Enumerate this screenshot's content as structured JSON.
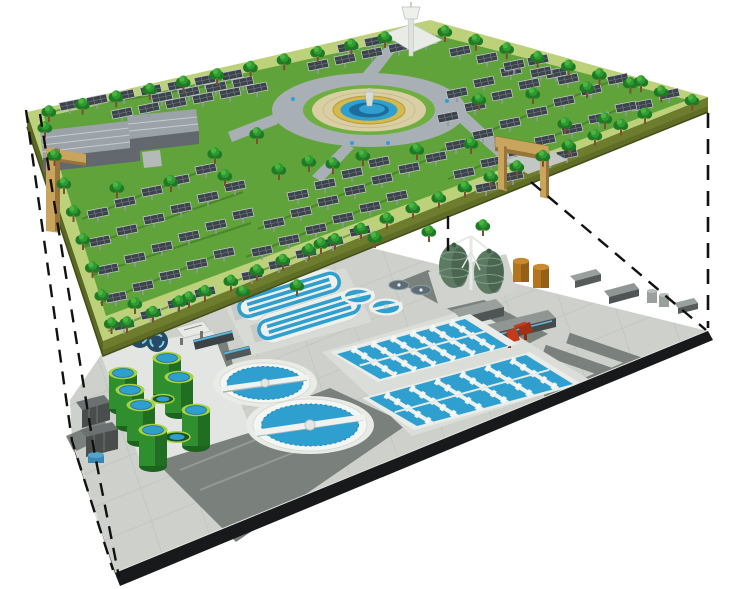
{
  "scene": {
    "description": "Cutaway concept illustration of a rooftop solar park and garden deck elevated above a wastewater treatment plant, with dashed projection lines linking the deck corners to the plant footprint",
    "upper_level": {
      "label": "Rooftop solar park and garden deck",
      "features": [
        {
          "name": "central-plaza",
          "label": "Circular plaza with tiered fountain",
          "count": 1
        },
        {
          "name": "observation-tower",
          "label": "White observation tower",
          "count": 1
        },
        {
          "name": "greenhouse-buildings",
          "label": "Gray ridged greenhouse buildings",
          "count": 2
        },
        {
          "name": "solar-panel-arrays",
          "label": "Rows of elevated solar panels",
          "approx_count": 107
        },
        {
          "name": "trees",
          "label": "Perimeter and infill trees",
          "approx_count": 74
        },
        {
          "name": "entrance-gates",
          "label": "Tan portal gate structures",
          "count": 2
        }
      ]
    },
    "lower_level": {
      "label": "Wastewater treatment plant",
      "features": [
        {
          "name": "circular-clarifiers",
          "label": "Circular clarifier tanks with rotating bridges",
          "count": 2
        },
        {
          "name": "oxidation-ditches",
          "label": "Racetrack oxidation ditches",
          "count": 2
        },
        {
          "name": "aeration-basins",
          "label": "Rectangular aeration basin blocks with walkways",
          "count": 2
        },
        {
          "name": "digester-eggs",
          "label": "Egg-shaped anaerobic digesters",
          "count": 2
        },
        {
          "name": "sludge-tanks-green",
          "label": "Green cylindrical sludge tanks",
          "count": 7
        },
        {
          "name": "storage-tanks-orange",
          "label": "Orange storage tanks",
          "count": 2
        },
        {
          "name": "small-round-tanks",
          "label": "Small round process tanks",
          "count": 4
        },
        {
          "name": "service-buildings",
          "label": "Gray service buildings",
          "count": 6
        },
        {
          "name": "red-pump-unit",
          "label": "Red pump equipment",
          "count": 1
        }
      ]
    },
    "annotations": {
      "label": "Dashed projection lines between deck and plant",
      "count": 5
    },
    "colors": {
      "grass": "#5fa33a",
      "grassEdge": "#bcd17a",
      "deckSide": "#6e7c2e",
      "deckSideDark": "#5a6823",
      "panel": "#3d434b",
      "tree": "#2f9a33",
      "treeDark": "#1f7a24",
      "treeLite": "#4cb53f",
      "trunk": "#7a5230",
      "plazaRoad": "#a9b0b5",
      "plazaPave": "#dacfa2",
      "fountainRing": "#d4b94f",
      "water": "#2f9fd0",
      "waterDark": "#1c6c9c",
      "pave": "#cdd0cb",
      "paveLine": "#b7bbb5",
      "roadDark": "#7a817c",
      "edgeBlack": "#17191a",
      "structWhite": "#eef0ec",
      "tankGreen": "#2f8f2f",
      "tankGreenDark": "#1d621f",
      "tankRim": "#a6d33c",
      "digester": "#5d7a62",
      "digesterDark": "#415c48",
      "orange": "#b5741f",
      "red": "#c63a1c",
      "bldGray": "#9aa09e",
      "bldDark": "#4f5554",
      "gate": "#c9a45c",
      "gateDark": "#97753a",
      "tower": "#e9ebe7",
      "navy": "#274b66",
      "dash": "#111111"
    }
  }
}
